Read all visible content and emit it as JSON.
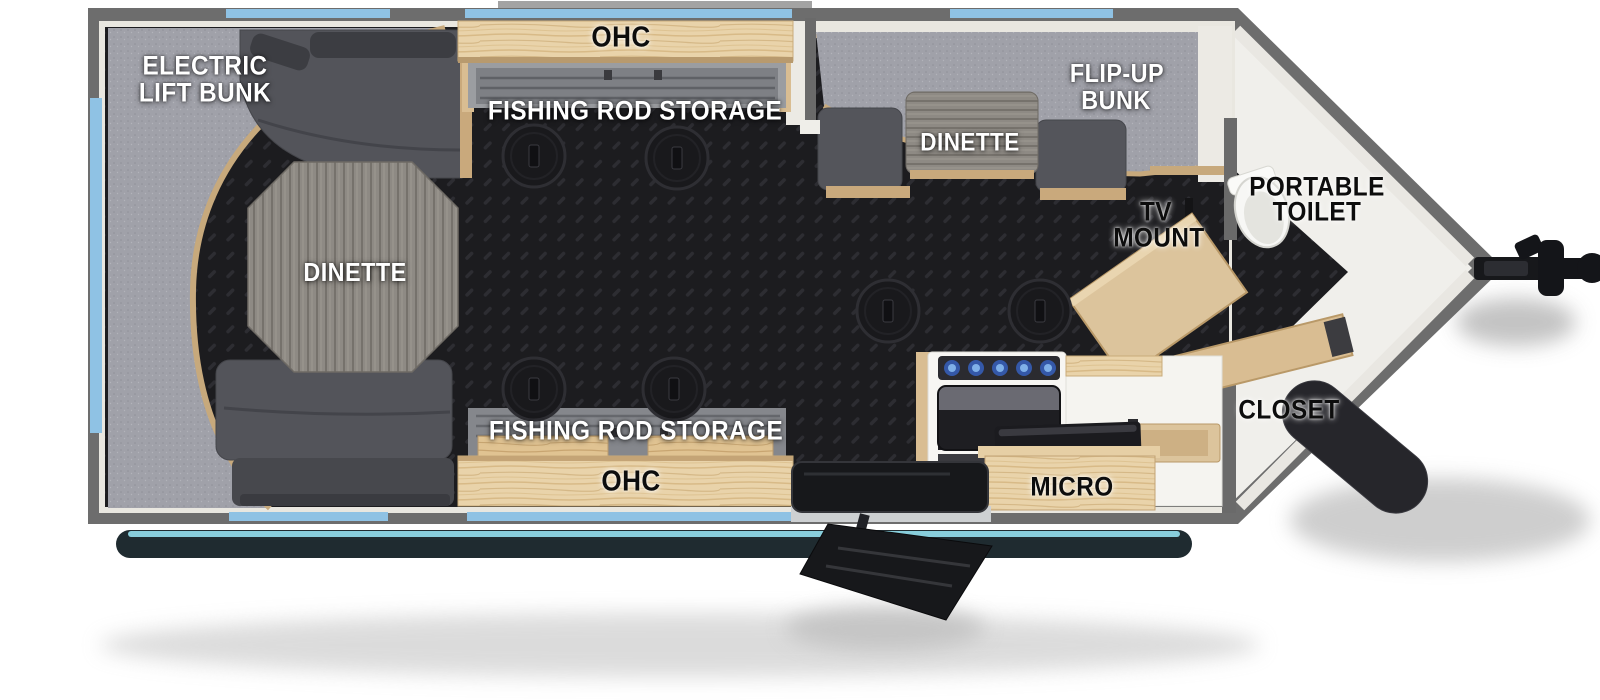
{
  "app": {
    "type": "travel-trailer-floorplan-diagram",
    "description": "Top-down RV fish house floorplan with rear electric lift bunk dinette, dual fishing rod storage with overhead cabinets, front v-nose with portable toilet and closet"
  },
  "floorplan": {
    "labels": {
      "electric_lift_bunk_line1": "ELECTRIC",
      "electric_lift_bunk_line2": "LIFT BUNK",
      "dinette_left": "DINETTE",
      "ohc_top": "OHC",
      "fishing_rod_storage_top": "FISHING ROD STORAGE",
      "flip_up_bunk_line1": "FLIP-UP",
      "flip_up_bunk_line2": "BUNK",
      "dinette_right": "DINETTE",
      "tv_mount_line1": "TV",
      "tv_mount_line2": "MOUNT",
      "portable_toilet_line1": "PORTABLE",
      "portable_toilet_line2": "TOILET",
      "closet": "CLOSET",
      "micro": "MICRO",
      "fishing_rod_storage_bottom": "FISHING ROD STORAGE",
      "ohc_bottom": "OHC"
    },
    "colors": {
      "wall_gray": "#6d6d6d",
      "floor_diamond_plate": "#1c1c1f",
      "window_blue": "#8fc2e4",
      "awning_accent_cyan": "#8ed7e6",
      "cabinet_wood": "#e9d3aa",
      "bunk_gray": "#a0a1a9",
      "sofa_gray": "#54555b",
      "nose_floor_white": "#f0efeb",
      "table_graywood": "#8e8a84"
    },
    "features": {
      "floor_fishing_holes": 6,
      "entry_door_side": "bottom",
      "hitch_side": "right"
    }
  }
}
